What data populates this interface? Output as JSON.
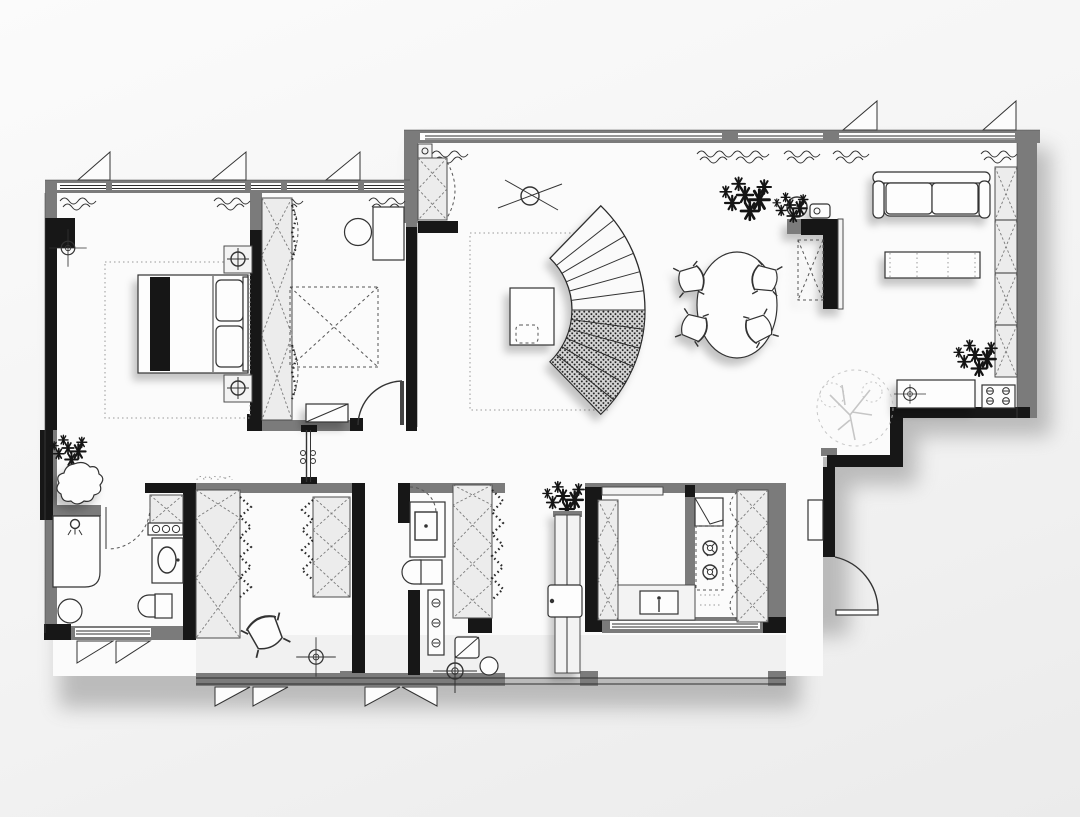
{
  "document": {
    "type": "residential apartment floor plan",
    "view": "top-down 2D plan, monochrome with soft shadows",
    "visible_text": ""
  },
  "palette": {
    "background": "#f4f4f4",
    "wall_gray": "#7b7b7b",
    "wall_black": "#171717",
    "floor": "#fbfbfb",
    "cabinet_fill": "#ececec",
    "line": "#333333",
    "balcony_floor": "#f1f1f1",
    "faded_tree": "#bdbdbd",
    "shadow": "rgba(0,0,0,0.30)"
  },
  "floor_plan": {
    "rooms": [
      {
        "id": "master-bedroom",
        "name": "Master bedroom",
        "position": "top-left",
        "items": [
          "double-bed",
          "black-blanket-stripe",
          "pillows",
          "nightstand-with-lamp-x2",
          "dotted-rug",
          "window-x2",
          "radiator-squiggle-x2",
          "ceiling-light-symbol"
        ]
      },
      {
        "id": "bedroom-2",
        "name": "Second bedroom",
        "position": "top-center",
        "items": [
          "wardrobe-strip",
          "dashed-future-bed",
          "desk",
          "round-chair",
          "bench",
          "door-swing",
          "window",
          "radiator-squiggle-x2"
        ]
      },
      {
        "id": "living-dining",
        "name": "Open living / dining room",
        "position": "right",
        "items": [
          "curved-staircase",
          "side-table",
          "ceiling-fan-symbol",
          "dotted-rug",
          "oval-dining-table",
          "dining-chair-x4",
          "black-bar-unit",
          "wall-clock",
          "entry-closet",
          "shoe-cabinet",
          "sofa",
          "tv-bench",
          "wall-shelving-column",
          "bench-seat",
          "electric-panel",
          "plant-large",
          "plant-small",
          "faded-tree",
          "window-strip",
          "radiator-squiggle-x6",
          "stepped-wall"
        ]
      },
      {
        "id": "corridor",
        "name": "Corridor",
        "position": "center-left",
        "items": [
          "pivot-glass-door"
        ]
      },
      {
        "id": "bathroom-1",
        "name": "Bathroom 1",
        "position": "bottom-left",
        "items": [
          "plant",
          "round-tub",
          "shower-head",
          "shower-tray",
          "stool",
          "washer-cabinet",
          "basin-cabinet",
          "toilet",
          "door-swing-dashed",
          "window-x2"
        ]
      },
      {
        "id": "walk-in-closet",
        "name": "Walk-in closet",
        "position": "bottom-center-left",
        "items": [
          "wardrobe-column-x2",
          "hanging-clothes-zigzag",
          "accordion-door",
          "chair",
          "ceiling-light-symbol"
        ]
      },
      {
        "id": "bathroom-2",
        "name": "Bathroom 2",
        "position": "bottom-center",
        "items": [
          "basin-cabinet",
          "toilet",
          "washing-machine",
          "control-knobs",
          "cabinet-column",
          "door-swing-dashed"
        ]
      },
      {
        "id": "hallway",
        "name": "Hallway",
        "position": "bottom-center",
        "items": [
          "plant",
          "tall-cabinet",
          "handle-box",
          "ceiling-light-symbol"
        ]
      },
      {
        "id": "kitchen",
        "name": "Kitchen",
        "position": "bottom-right",
        "items": [
          "u-shaped-counter",
          "sink",
          "cooktop-2-burner",
          "corner-cabinet",
          "cabinet-column-left",
          "cabinet-column-right",
          "fridge-niche",
          "window"
        ]
      },
      {
        "id": "balcony",
        "name": "Balcony strip",
        "position": "bottom",
        "items": [
          "railing",
          "openable-window-x4"
        ]
      },
      {
        "id": "entry",
        "name": "Entry vestibule",
        "position": "bottom-right",
        "items": [
          "entry-door-swing"
        ]
      }
    ],
    "icons": [
      "ceiling-light-icon",
      "shower-head-icon",
      "plant-icon",
      "tree-icon",
      "radiator-squiggle-icon",
      "window-opening-triangle-icon",
      "stair-fan-icon"
    ]
  }
}
